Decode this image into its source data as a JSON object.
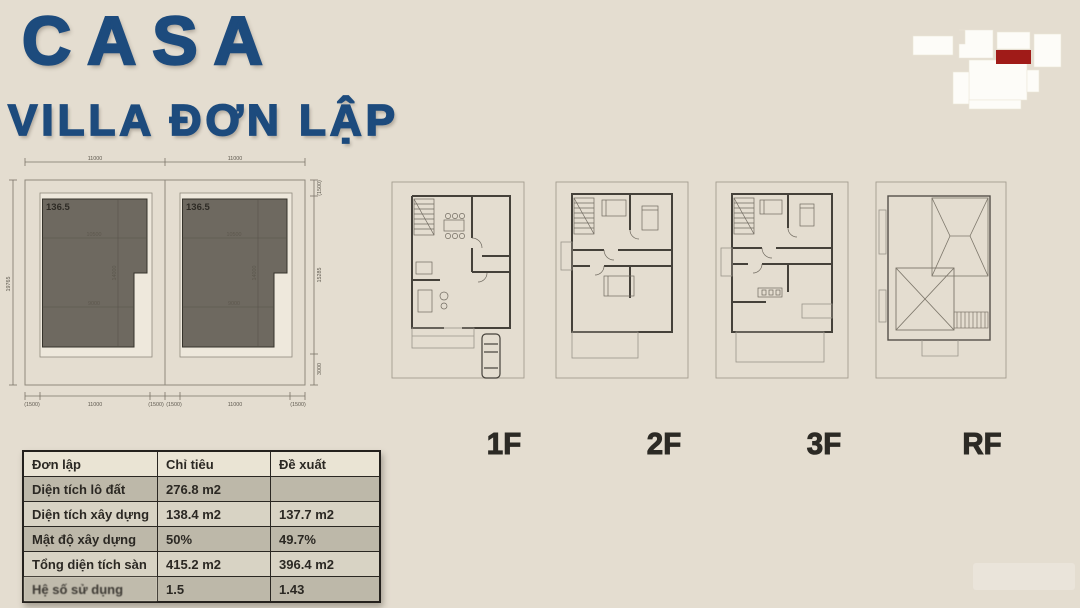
{
  "header": {
    "title": "CASA",
    "subtitle": "VILLA ĐƠN LẬP",
    "title_color": "#1d4b7d"
  },
  "minimap": {
    "highlight_color": "#a01b18",
    "block_color": "#fdfcf8"
  },
  "site_plan": {
    "dims": {
      "top": [
        "11000",
        "11000"
      ],
      "left": "19765",
      "right": [
        "(1500)",
        "15285",
        "3000"
      ],
      "bottom": [
        "(1500)",
        "11000",
        "(1500)",
        "(1500)",
        "11000",
        "(1500)"
      ]
    },
    "lots": [
      {
        "area": "136.5",
        "width_top": "10500",
        "depth": "14000",
        "width_bottom": "9000"
      },
      {
        "area": "136.5",
        "width_top": "10500",
        "depth": "14000",
        "width_bottom": "9000"
      }
    ],
    "footprint_color": "#6e6960"
  },
  "floors": [
    {
      "label": "1F"
    },
    {
      "label": "2F"
    },
    {
      "label": "3F"
    },
    {
      "label": "RF"
    }
  ],
  "table": {
    "headers": [
      "Đơn lập",
      "Chỉ tiêu",
      "Đề xuất"
    ],
    "rows": [
      {
        "label": "Diện tích lô đất",
        "target": "276.8 m2",
        "proposed": ""
      },
      {
        "label": "Diện tích xây dựng",
        "target": "138.4 m2",
        "proposed": "137.7 m2"
      },
      {
        "label": "Mật độ xây dựng",
        "target": "50%",
        "proposed": "49.7%"
      },
      {
        "label": "Tổng diện tích sàn",
        "target": "415.2 m2",
        "proposed": "396.4 m2"
      },
      {
        "label": "Hệ số sử dụng",
        "target": "1.5",
        "proposed": "1.43"
      }
    ]
  },
  "colors": {
    "background": "#e4ddd0",
    "accent_blue": "#1d4b7d",
    "accent_red": "#a01b18",
    "table_shade": "#bdb8a9",
    "table_light": "#d8d3c4"
  }
}
